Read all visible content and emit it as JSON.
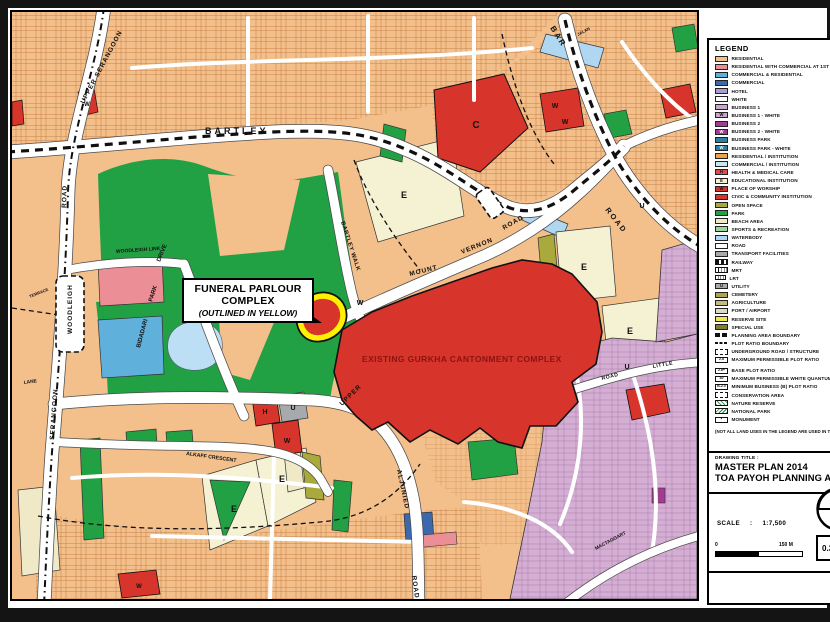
{
  "colors": {
    "residential": "#F3BF8B",
    "rescom": "#EC8E96",
    "comres": "#5FB1DC",
    "commercial": "#3C68AE",
    "b2": "#A23C92",
    "edu": "#F4F2D2",
    "civic": "#D7342B",
    "open": "#A9AA3B",
    "park": "#21A143",
    "beach": "#EFE9C8",
    "water": "#AFD7F2",
    "pond": "#BCDFF5",
    "transport": "#A7AAAC",
    "mauve": "#D5AFD3",
    "yellow_outline": "#FFF100",
    "gurkha_text": "#8B1410",
    "texline": "#C07A3E",
    "texline2": "#9C6FA1"
  },
  "legend": {
    "title": "LEGEND",
    "note": "(NOT ALL LAND USES IN THE LEGEND ARE USED IN THIS PLAN)",
    "items": [
      {
        "label": "RESIDENTIAL",
        "type": "c",
        "color": "#F3BF8B"
      },
      {
        "label": "RESIDENTIAL WITH COMMERCIAL AT 1ST STOREY",
        "type": "c",
        "color": "#EC8E96"
      },
      {
        "label": "COMMERCIAL & RESIDENTIAL",
        "type": "c",
        "color": "#5FB1DC"
      },
      {
        "label": "COMMERCIAL",
        "type": "c",
        "color": "#3C68AE"
      },
      {
        "label": "HOTEL",
        "type": "c",
        "color": "#A89ED0"
      },
      {
        "label": "WHITE",
        "type": "c",
        "color": "#FFFFFF"
      },
      {
        "label": "BUSINESS 1",
        "type": "c",
        "color": "#C9A6CD"
      },
      {
        "label": "BUSINESS 1 - WHITE",
        "type": "cl",
        "color": "#C9A6CD",
        "letter": "W"
      },
      {
        "label": "BUSINESS 2",
        "type": "c",
        "color": "#A23C92"
      },
      {
        "label": "BUSINESS 2 - WHITE",
        "type": "cl",
        "color": "#A23C92",
        "letter": "W",
        "lc": "#fff"
      },
      {
        "label": "BUSINESS PARK",
        "type": "c",
        "color": "#2F7FA3"
      },
      {
        "label": "BUSINESS PARK - WHITE",
        "type": "cl",
        "color": "#2F7FA3",
        "letter": "W",
        "lc": "#fff"
      },
      {
        "label": "RESIDENTIAL / INSTITUTION",
        "type": "c",
        "color": "#EFA24E"
      },
      {
        "label": "COMMERCIAL / INSTITUTION",
        "type": "c",
        "color": "#C3EAEF"
      },
      {
        "label": "HEALTH & MEDICAL CARE",
        "type": "cl",
        "color": "#DF4D48",
        "letter": "H"
      },
      {
        "label": "EDUCATIONAL INSTITUTION",
        "type": "cl",
        "color": "#F4F2D2",
        "letter": "E"
      },
      {
        "label": "PLACE OF WORSHIP",
        "type": "cl",
        "color": "#D7342B",
        "letter": "W"
      },
      {
        "label": "CIVIC & COMMUNITY INSTITUTION",
        "type": "c",
        "color": "#D7342B"
      },
      {
        "label": "OPEN SPACE",
        "type": "c",
        "color": "#A9AA3B"
      },
      {
        "label": "PARK",
        "type": "c",
        "color": "#21A143"
      },
      {
        "label": "BEACH AREA",
        "type": "c",
        "color": "#EFE9C8"
      },
      {
        "label": "SPORTS & RECREATION",
        "type": "c",
        "color": "#9BD69B"
      },
      {
        "label": "WATERBODY",
        "type": "c",
        "color": "#AFD7F2"
      },
      {
        "label": "ROAD",
        "type": "c",
        "color": "#FFFFFF"
      },
      {
        "label": "TRANSPORT FACILITIES",
        "type": "c",
        "color": "#A7AAAC"
      },
      {
        "label": "RAILWAY",
        "type": "rail"
      },
      {
        "label": "MRT",
        "type": "mrt"
      },
      {
        "label": "LRT",
        "type": "lrt"
      },
      {
        "label": "UTILITY",
        "type": "cl",
        "color": "#A7AAAC",
        "letter": "U"
      },
      {
        "label": "CEMETERY",
        "type": "c",
        "color": "#AFA44B"
      },
      {
        "label": "AGRICULTURE",
        "type": "c",
        "color": "#C6B97E"
      },
      {
        "label": "PORT / AIRPORT",
        "type": "c",
        "color": "#DADACD"
      },
      {
        "label": "RESERVE SITE",
        "type": "c",
        "color": "#F2E94A"
      },
      {
        "label": "SPECIAL USE",
        "type": "c",
        "color": "#7C7F2F"
      },
      {
        "label": "PLANNING AREA BOUNDARY",
        "type": "bound"
      },
      {
        "label": "PLOT RATIO BOUNDARY",
        "type": "pratio"
      },
      {
        "label": "UNDERGROUND ROAD / STRUCTURE",
        "type": "und"
      },
      {
        "label": "MAXIMUM PERMISSIBLE PLOT RATIO",
        "type": "rbox",
        "text": "2.8",
        "wrap": true
      },
      {
        "label": "BASE PLOT RATIO",
        "type": "rbox",
        "text": "2.8+"
      },
      {
        "label": "MAXIMUM PERMISSIBLE WHITE QUANTUM",
        "type": "rbox",
        "text": "40"
      },
      {
        "label": "MINIMUM BUSINESS (B) PLOT RATIO",
        "type": "rbox",
        "text": "B-2.0"
      },
      {
        "label": "CONSERVATION AREA",
        "type": "cons"
      },
      {
        "label": "NATURE RESERVE",
        "type": "hg"
      },
      {
        "label": "NATIONAL PARK",
        "type": "hg2"
      },
      {
        "label": "MONUMENT",
        "type": "mon"
      }
    ]
  },
  "title_block": {
    "label": "DRAWING TITLE :",
    "line1": "MASTER PLAN 2014",
    "line2": "TOA PAYOH PLANNING AREA"
  },
  "scale_block": {
    "label": "SCALE",
    "sep": ":",
    "value": "1:7,500",
    "bar_start": "0",
    "bar_end": "150 M",
    "area_value": "0.3 Ha"
  },
  "callout": {
    "line1": "FUNERAL PARLOUR",
    "line2": "COMPLEX",
    "line3": "(OUTLINED IN YELLOW)"
  },
  "map": {
    "complex_label": "EXISTING GURKHA CANTONMENT COMPLEX",
    "labels": [
      {
        "t": "BARTLEY",
        "x": 193,
        "y": 122,
        "r": 0,
        "s": 9,
        "w": 700,
        "ls": 3
      },
      {
        "t": "UPPER  SERANGOON",
        "x": 72,
        "y": 92,
        "r": -62,
        "s": 6.5,
        "ls": 1
      },
      {
        "t": "ROAD",
        "x": 54,
        "y": 196,
        "r": -88,
        "s": 6.5,
        "ls": 1
      },
      {
        "t": "WOODLEIGH  LINK",
        "x": 104,
        "y": 241,
        "r": -4,
        "s": 5
      },
      {
        "t": "WOODLEIGH",
        "x": 60,
        "y": 322,
        "r": -90,
        "s": 6.5,
        "ls": 1
      },
      {
        "t": "DRIVE",
        "x": 148,
        "y": 250,
        "r": -68,
        "s": 6
      },
      {
        "t": "PARK",
        "x": 140,
        "y": 290,
        "r": -72,
        "s": 6
      },
      {
        "t": "BIDADARI",
        "x": 128,
        "y": 336,
        "r": -75,
        "s": 6
      },
      {
        "t": "SERANGOON",
        "x": 42,
        "y": 428,
        "r": -86,
        "s": 6.5,
        "ls": 1
      },
      {
        "t": "LANE",
        "x": 12,
        "y": 372,
        "r": -8,
        "s": 4.8
      },
      {
        "t": "TERRACE",
        "x": 18,
        "y": 286,
        "r": -22,
        "s": 4.2
      },
      {
        "t": "ALKAFF CRESCENT",
        "x": 174,
        "y": 443,
        "r": 8,
        "s": 5.2
      },
      {
        "t": "UPPER",
        "x": 330,
        "y": 394,
        "r": -44,
        "s": 6.5,
        "ls": 1
      },
      {
        "t": "ALJUNIED",
        "x": 385,
        "y": 458,
        "r": 78,
        "s": 6.5,
        "ls": 1
      },
      {
        "t": "ROAD",
        "x": 400,
        "y": 564,
        "r": 82,
        "s": 6.5,
        "ls": 1
      },
      {
        "t": "BARTLEY WALK",
        "x": 329,
        "y": 210,
        "r": 72,
        "s": 5.8,
        "ls": 0.5
      },
      {
        "t": "MOUNT",
        "x": 398,
        "y": 264,
        "r": -14,
        "s": 6.5,
        "ls": 1
      },
      {
        "t": "VERNON",
        "x": 450,
        "y": 242,
        "r": -22,
        "s": 6.5,
        "ls": 1
      },
      {
        "t": "ROAD",
        "x": 492,
        "y": 218,
        "r": -30,
        "s": 6.5,
        "ls": 1
      },
      {
        "t": "BAR",
        "x": 538,
        "y": 16,
        "r": 58,
        "s": 8,
        "w": 700,
        "ls": 2
      },
      {
        "t": "ROAD",
        "x": 593,
        "y": 198,
        "r": 52,
        "s": 7.5,
        "w": 700,
        "ls": 2
      },
      {
        "t": "JALAN",
        "x": 566,
        "y": 24,
        "r": -28,
        "s": 4.2
      },
      {
        "t": "LITTLE",
        "x": 641,
        "y": 356,
        "r": -10,
        "s": 5.2,
        "ls": 0.5
      },
      {
        "t": "ROAD",
        "x": 590,
        "y": 368,
        "r": -14,
        "s": 5.2,
        "ls": 0.5
      },
      {
        "t": "MACTAGGART",
        "x": 584,
        "y": 538,
        "r": -28,
        "s": 4.8
      },
      {
        "t": "EXISTING GURKHA CANTONMENT COMPLEX",
        "x": 350,
        "y": 350,
        "r": 0,
        "s": 8.5,
        "w": 700,
        "ls": 0.4,
        "cls": "gurkha"
      }
    ],
    "markers": [
      {
        "t": "W",
        "x": 348,
        "y": 293
      },
      {
        "t": "W",
        "x": 543,
        "y": 96
      },
      {
        "t": "W",
        "x": 553,
        "y": 112
      },
      {
        "t": "C",
        "x": 464,
        "y": 116,
        "s": 10
      },
      {
        "t": "W",
        "x": 75,
        "y": 94,
        "s": 6
      },
      {
        "t": "H",
        "x": 253,
        "y": 402
      },
      {
        "t": "U",
        "x": 281,
        "y": 398
      },
      {
        "t": "W",
        "x": 275,
        "y": 431
      },
      {
        "t": "U",
        "x": 615,
        "y": 357
      },
      {
        "t": "U",
        "x": 630,
        "y": 196
      },
      {
        "t": "E",
        "x": 392,
        "y": 186,
        "s": 9
      },
      {
        "t": "E",
        "x": 572,
        "y": 258,
        "s": 9
      },
      {
        "t": "E",
        "x": 618,
        "y": 322,
        "s": 9
      },
      {
        "t": "E",
        "x": 222,
        "y": 500,
        "s": 9
      },
      {
        "t": "E",
        "x": 270,
        "y": 470,
        "s": 9
      },
      {
        "t": "W",
        "x": 127,
        "y": 576,
        "s": 6
      }
    ]
  }
}
